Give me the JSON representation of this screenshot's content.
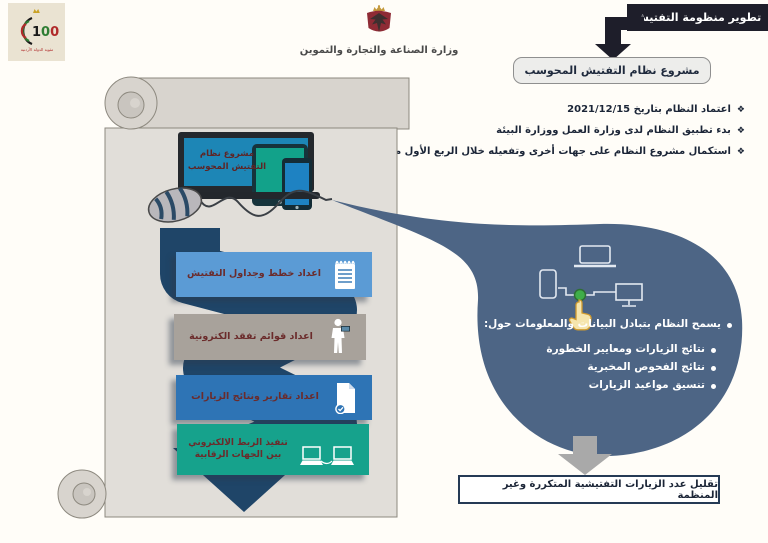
{
  "header": {
    "centennial": {
      "number": "100",
      "caption": "مئوية الدولة الأردنية"
    },
    "ministry_name": "وزارة الصناعة والتجارة والتموين",
    "title_badge": "تطوير منظومة التفتيش",
    "project_box": "مشروع نظام التفتيش المحوسب"
  },
  "markers": {
    "diamond": "❖"
  },
  "milestones": [
    "اعتماد النظام بتاريخ 2021/12/15",
    "بدء تطبيق النظام لدى وزارة العمل ووزارة البيئة",
    "استكمال مشروع النظام على جهات أخرى وتفعيله خلال الربع الأول من عام 2022"
  ],
  "device_screen_title": "مشروع نظام التفتيش المحوسب",
  "process_steps": [
    {
      "label": "اعداد خطط وجداول التفتيش",
      "icon": "notepad-icon",
      "color": "#5b9bd5"
    },
    {
      "label": "اعداد قوائم تفقد الكترونية",
      "icon": "inspector-icon",
      "color": "#a8a29b"
    },
    {
      "label": "اعداد تقارير ونتائج الزيارات",
      "icon": "report-check-icon",
      "color": "#2e74b5"
    },
    {
      "label": "تنفيذ الربط الالكتروني بين الجهات الرقابية",
      "icon": "linked-computers-icon",
      "color": "#16a28c"
    }
  ],
  "bubble": {
    "color": "#4d6585",
    "intro": "يسمح النظام بتبادل البيانات والمعلومات حول:",
    "points": [
      "نتائج الزيارات ومعايير الخطورة",
      "نتائج الفحوص المخبرية",
      "تنسيق مواعيد الزيارات"
    ]
  },
  "outcome": "تقليل عدد الزيارات التفتيشية المتكررة وغير المنظمة",
  "colors": {
    "badge_black": "#1e1e2a",
    "ribbon_navy": "#1f4568",
    "bubble_slate": "#4d6585",
    "scroll_gray": "#e1ded9",
    "laptop_screen_blue": "#1d86b6",
    "tablet_teal": "#12a28a",
    "step_text_maroon": "#6b2b2b",
    "text_navy": "#1b2537",
    "outcome_border": "#253a55"
  }
}
